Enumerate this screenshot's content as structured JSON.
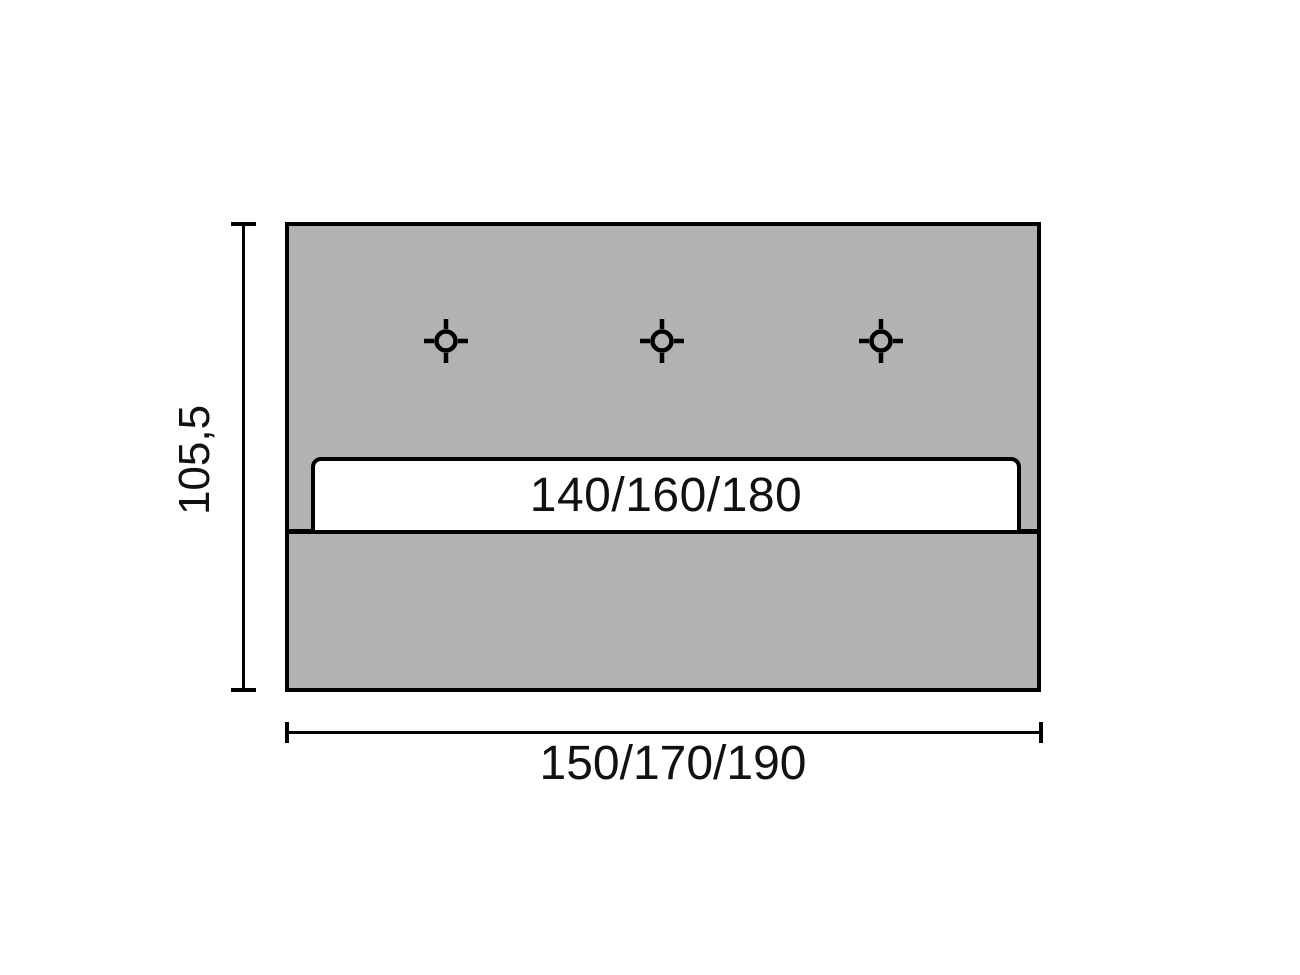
{
  "diagram": {
    "slat": {
      "label": "140/160/180"
    },
    "dimensions": {
      "height": {
        "label": "105,5"
      },
      "width": {
        "label": "150/170/190"
      }
    },
    "markers": {
      "icon": "crosshair-target-icon",
      "count": 3
    },
    "colors": {
      "background": "#ffffff",
      "panel_fill": "#b2b2b2",
      "slat_fill": "#ffffff",
      "outline": "#000000",
      "text": "#111111"
    }
  }
}
